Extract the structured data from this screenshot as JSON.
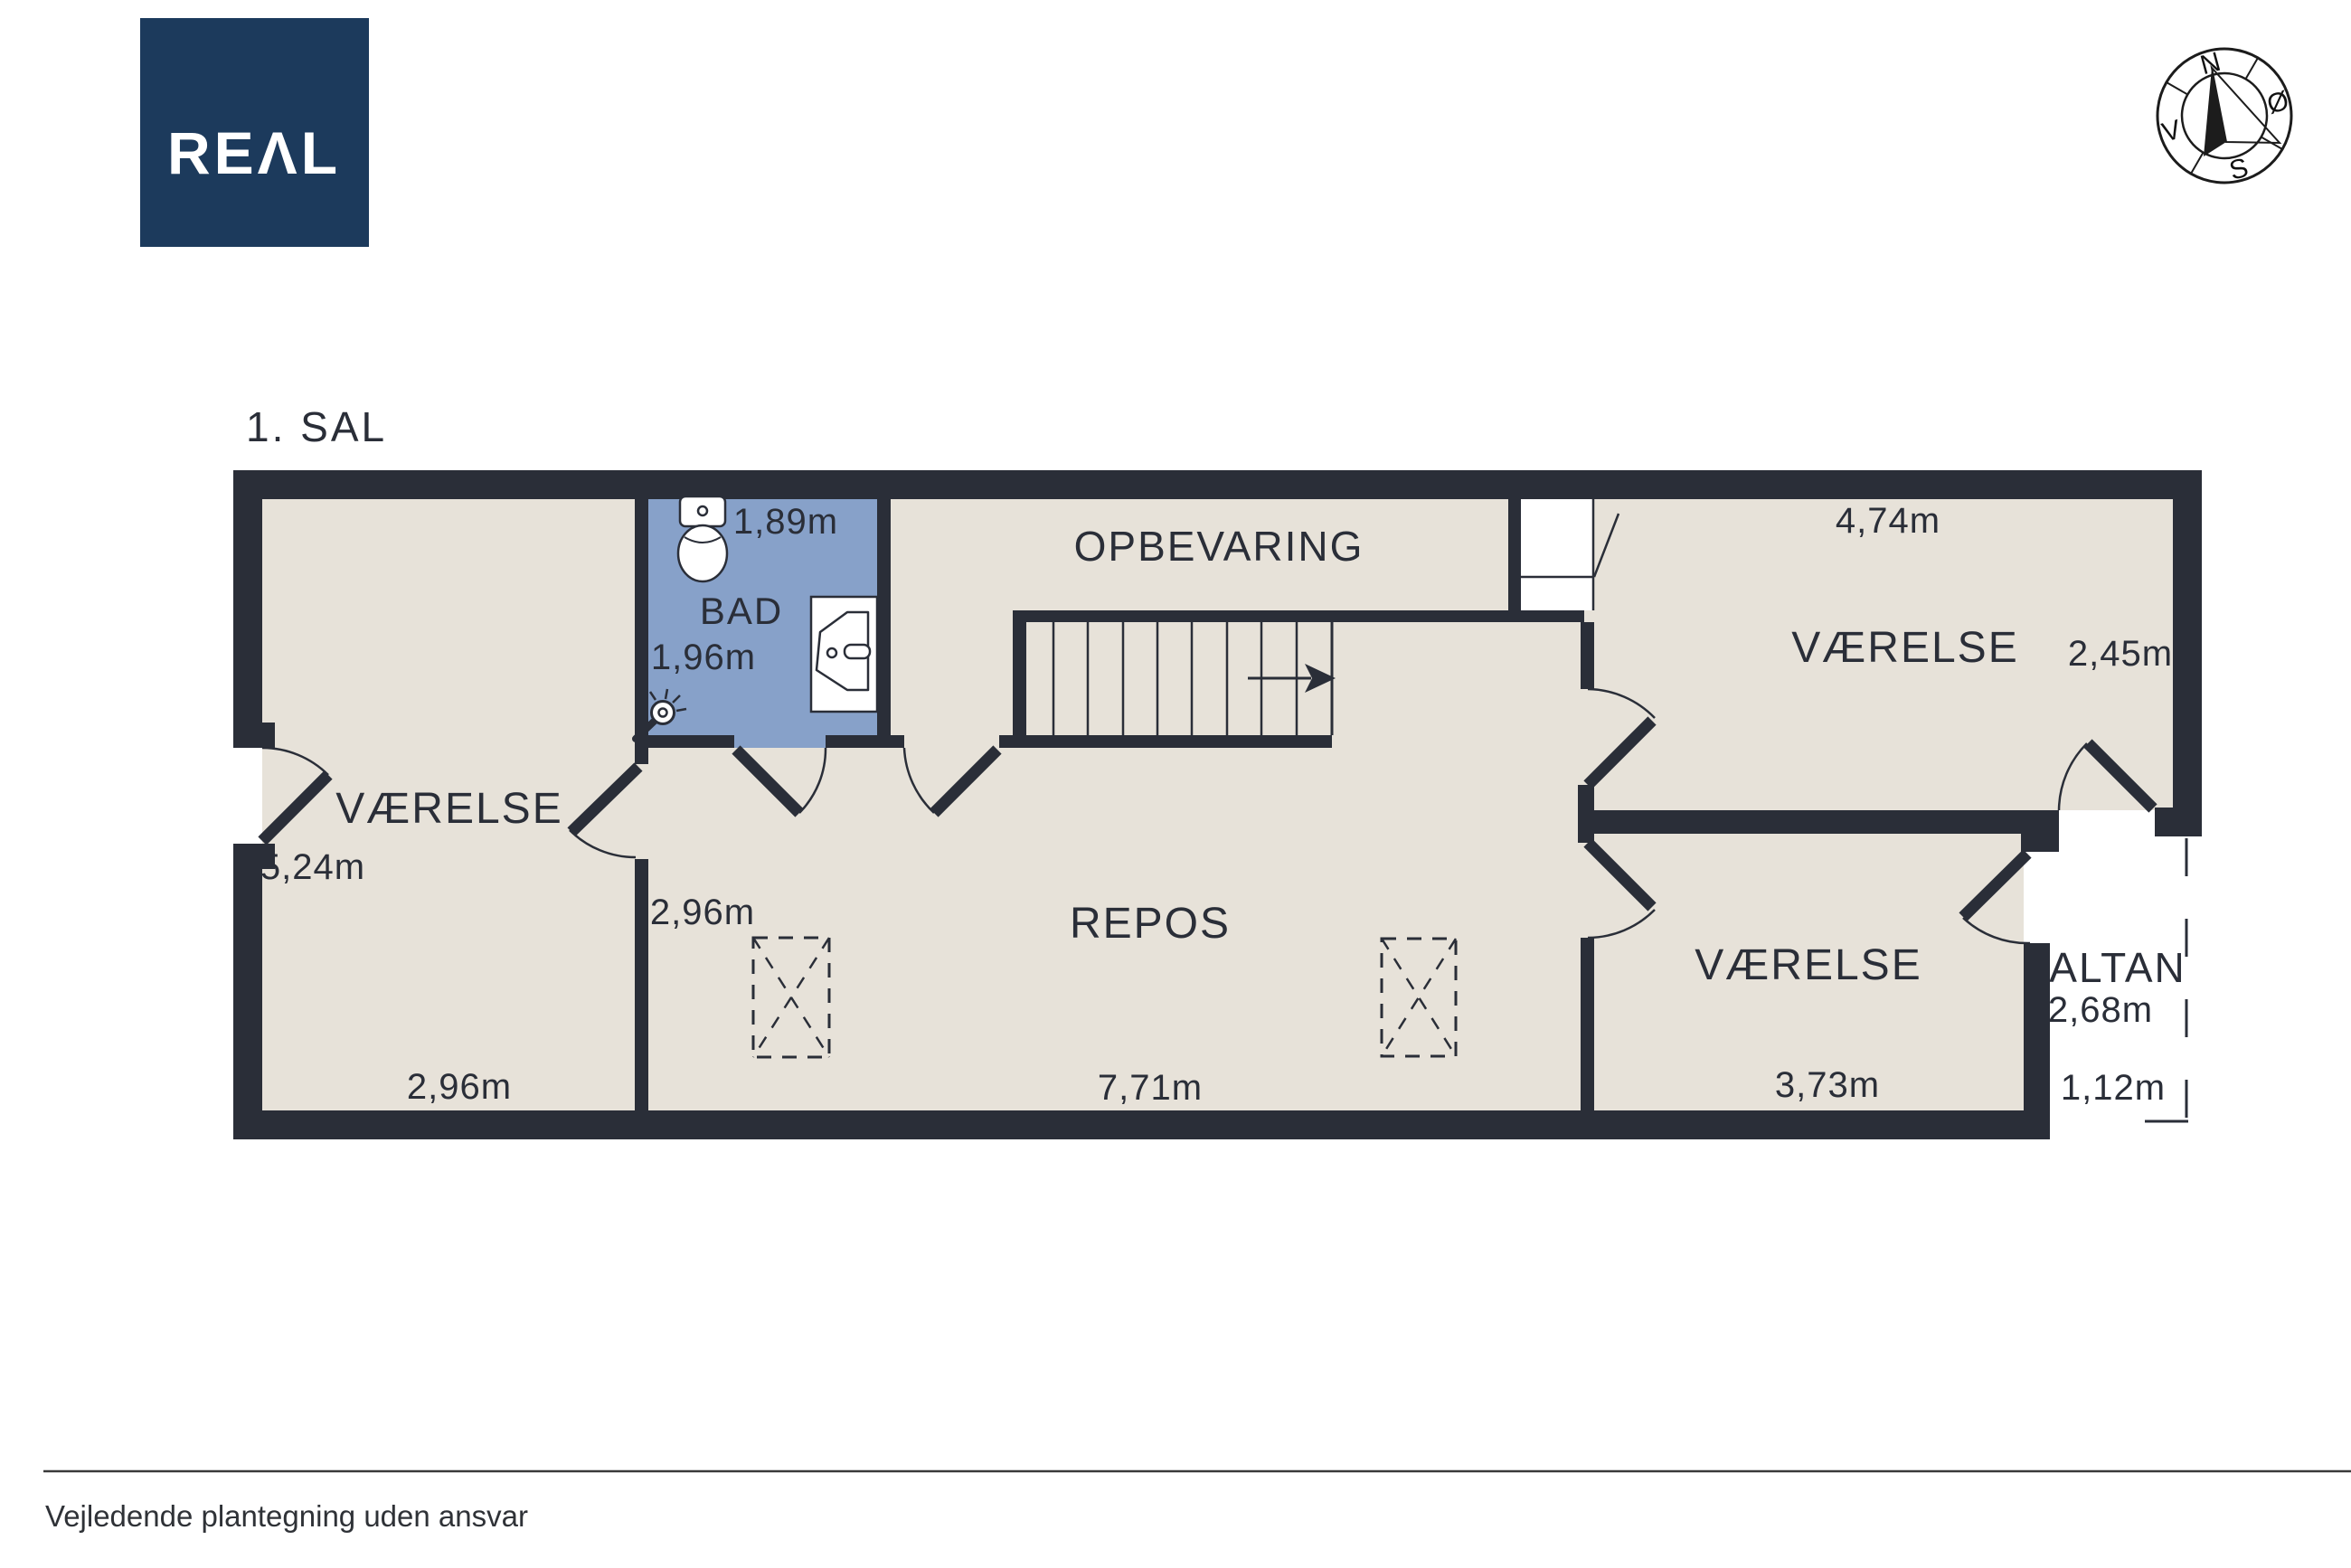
{
  "page": {
    "title": "1. SAL",
    "disclaimer": "Vejledende plantegning uden ansvar"
  },
  "logo": {
    "text": "REΛL",
    "background": "#1C3A5C"
  },
  "compass": {
    "north": "N",
    "east": "Ø",
    "south": "S",
    "west": "V"
  },
  "colors": {
    "wall": "#2A2E38",
    "floor": "#E7E2D9",
    "bathroom_floor": "#87A1C9",
    "outside": "#FFFFFF",
    "text": "#2A2E38",
    "logo_background": "#1C3A5C"
  },
  "rooms": {
    "vaerelse_left": {
      "label": "VÆRELSE",
      "height": "5,24m",
      "width": "2,96m"
    },
    "bad": {
      "label": "BAD",
      "width": "1,89m",
      "height": "1,96m"
    },
    "opbevaring": {
      "label": "OPBEVARING"
    },
    "repos": {
      "label": "REPOS",
      "width": "7,71m",
      "corridor_width": "2,96m"
    },
    "vaerelse_ne": {
      "label": "VÆRELSE",
      "width": "4,74m",
      "height": "2,45m"
    },
    "vaerelse_se": {
      "label": "VÆRELSE",
      "width": "3,73m"
    },
    "altan": {
      "label": "ALTAN",
      "height": "2,68m",
      "width": "1,12m"
    }
  }
}
